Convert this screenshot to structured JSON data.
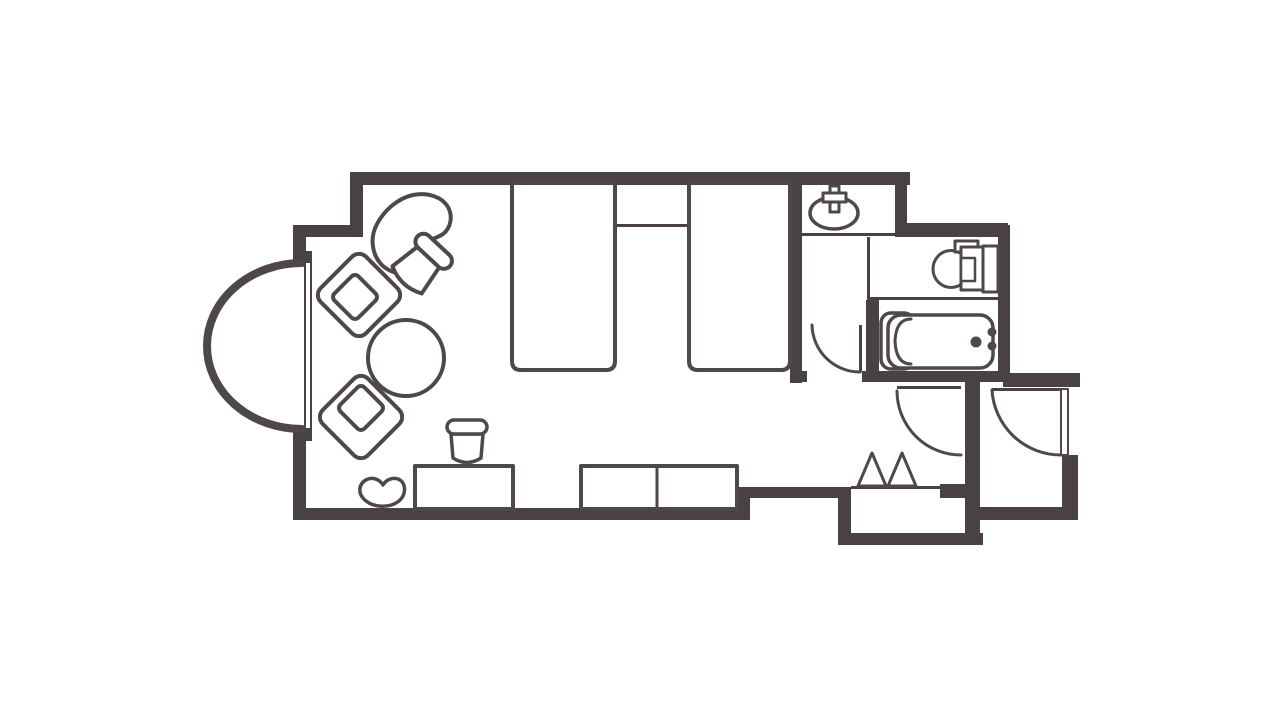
{
  "canvas": {
    "width": 1280,
    "height": 720,
    "background": "#ffffff"
  },
  "palette": {
    "wall": "#494142",
    "line": "#4f4849",
    "fill": "#ffffff"
  },
  "floorplan": {
    "description": "hotel-guest-room-floor-plan",
    "shapes": [
      {
        "name": "top-wall",
        "type": "rect",
        "x": 350,
        "y": 172,
        "w": 560,
        "h": 13,
        "fill": "wall"
      },
      {
        "name": "step-wall-vertical",
        "type": "rect",
        "x": 350,
        "y": 172,
        "w": 13,
        "h": 65,
        "fill": "wall"
      },
      {
        "name": "step-wall-horizontal",
        "type": "rect",
        "x": 293,
        "y": 225,
        "w": 70,
        "h": 12,
        "fill": "wall"
      },
      {
        "name": "left-wall-upper",
        "type": "rect",
        "x": 293,
        "y": 225,
        "w": 13,
        "h": 38,
        "fill": "wall"
      },
      {
        "name": "window-nub-top",
        "type": "rect",
        "x": 293,
        "y": 251,
        "w": 19,
        "h": 12,
        "fill": "wall"
      },
      {
        "name": "left-wall-lower",
        "type": "rect",
        "x": 293,
        "y": 428,
        "w": 13,
        "h": 92,
        "fill": "wall"
      },
      {
        "name": "window-nub-bottom",
        "type": "rect",
        "x": 293,
        "y": 428,
        "w": 19,
        "h": 13,
        "fill": "wall"
      },
      {
        "name": "bottom-wall-main",
        "type": "rect",
        "x": 293,
        "y": 508,
        "w": 457,
        "h": 12,
        "fill": "wall"
      },
      {
        "name": "bottom-wall-step",
        "type": "rect",
        "x": 737,
        "y": 487,
        "w": 13,
        "h": 33,
        "fill": "wall"
      },
      {
        "name": "bottom-wall-right",
        "type": "rect",
        "x": 737,
        "y": 487,
        "w": 110,
        "h": 11,
        "fill": "wall"
      },
      {
        "name": "genkan-wall-left",
        "type": "rect",
        "x": 838,
        "y": 487,
        "w": 13,
        "h": 58,
        "fill": "wall"
      },
      {
        "name": "genkan-wall-bottom",
        "type": "rect",
        "x": 838,
        "y": 533,
        "w": 145,
        "h": 12,
        "fill": "wall"
      },
      {
        "name": "entry-divider-wall",
        "type": "rect",
        "x": 965,
        "y": 378,
        "w": 15,
        "h": 167,
        "fill": "wall"
      },
      {
        "name": "entry-divider-nub",
        "type": "rect",
        "x": 940,
        "y": 484,
        "w": 26,
        "h": 14,
        "fill": "wall"
      },
      {
        "name": "entry-bottom-wall",
        "type": "rect",
        "x": 978,
        "y": 507,
        "w": 100,
        "h": 13,
        "fill": "wall"
      },
      {
        "name": "entry-right-wall",
        "type": "rect",
        "x": 1062,
        "y": 455,
        "w": 16,
        "h": 65,
        "fill": "wall"
      },
      {
        "name": "entry-top-wall",
        "type": "rect",
        "x": 1003,
        "y": 373,
        "w": 77,
        "h": 14,
        "fill": "wall"
      },
      {
        "name": "bathroom-right-wall",
        "type": "rect",
        "x": 998,
        "y": 225,
        "w": 12,
        "h": 157,
        "fill": "wall"
      },
      {
        "name": "bathroom-bottom-wall-left",
        "type": "rect",
        "x": 790,
        "y": 371,
        "w": 17,
        "h": 11,
        "fill": "wall"
      },
      {
        "name": "bathroom-bottom-wall",
        "type": "rect",
        "x": 862,
        "y": 371,
        "w": 148,
        "h": 11,
        "fill": "wall"
      },
      {
        "name": "sink-room-right-wall",
        "type": "rect",
        "x": 895,
        "y": 172,
        "w": 12,
        "h": 65,
        "fill": "wall"
      },
      {
        "name": "toilet-room-top-wall",
        "type": "rect",
        "x": 895,
        "y": 223,
        "w": 113,
        "h": 14,
        "fill": "wall"
      },
      {
        "name": "bedroom-bathroom-wall",
        "type": "rect",
        "x": 790,
        "y": 173,
        "w": 12,
        "h": 210,
        "fill": "wall"
      },
      {
        "name": "tub-room-left-wall",
        "type": "rect",
        "x": 866,
        "y": 300,
        "w": 13,
        "h": 82,
        "fill": "wall"
      },
      {
        "name": "sink-counter-line",
        "type": "rect",
        "x": 797,
        "y": 233,
        "w": 98,
        "h": 3,
        "fill": "wall"
      },
      {
        "name": "washroom-toilet-partition",
        "type": "rect",
        "x": 867,
        "y": 237,
        "w": 3,
        "h": 63,
        "fill": "wall"
      },
      {
        "name": "toilet-tub-partition",
        "type": "rect",
        "x": 867,
        "y": 297,
        "w": 133,
        "h": 3,
        "fill": "wall"
      },
      {
        "name": "bay-window-glass-outer",
        "type": "rect",
        "x": 304,
        "y": 262,
        "w": 2,
        "h": 167,
        "fill": "wall"
      },
      {
        "name": "bay-window-glass-inner",
        "type": "rect",
        "x": 310,
        "y": 262,
        "w": 2,
        "h": 167,
        "fill": "wall"
      },
      {
        "name": "nightstand-front-line",
        "type": "rect",
        "x": 617,
        "y": 224,
        "w": 71,
        "h": 3,
        "fill": "wall"
      },
      {
        "name": "genkan-threshold-line",
        "type": "rect",
        "x": 851,
        "y": 486,
        "w": 90,
        "h": 3,
        "fill": "wall"
      },
      {
        "name": "hall-door-leaf",
        "type": "rect",
        "x": 897,
        "y": 386,
        "w": 64,
        "h": 3,
        "fill": "wall"
      },
      {
        "name": "washroom-door-leaf",
        "type": "rect",
        "x": 859,
        "y": 325,
        "w": 3,
        "h": 47,
        "fill": "wall"
      },
      {
        "name": "entrance-door-header-line",
        "type": "rect",
        "x": 992,
        "y": 388,
        "w": 69,
        "h": 3,
        "fill": "wall"
      },
      {
        "name": "bay-window-arc",
        "type": "path",
        "d": "M 302,263 A 95,83 0 0 0 302,429",
        "sw": 8,
        "fill": "none"
      },
      {
        "name": "washroom-door-arc",
        "type": "path",
        "d": "M 812,325 A 48,48 0 0 0 860,372",
        "sw": 3,
        "fill": "none"
      },
      {
        "name": "hall-door-arc",
        "type": "path",
        "d": "M 897,391 A 64,64 0 0 0 961,455",
        "sw": 3,
        "fill": "none"
      },
      {
        "name": "entrance-door-arc",
        "type": "path",
        "d": "M 992,390 A 69,69 0 0 0 1061,455",
        "sw": 3,
        "fill": "none"
      },
      {
        "name": "entrance-door-leaf",
        "type": "rect",
        "x": 1061,
        "y": 389,
        "w": 7,
        "h": 66,
        "sw": 2,
        "fill": "white"
      },
      {
        "name": "bed-1",
        "type": "path",
        "d": "M 512,183 L 512,361 Q 512,370 521,370 L 606,370 Q 615,370 615,361 L 615,183 Z",
        "sw": 4,
        "fill": "white"
      },
      {
        "name": "bed-2",
        "type": "path",
        "d": "M 689,183 L 689,361 Q 689,370 698,370 L 781,370 Q 790,370 790,361 L 790,183 Z",
        "sw": 4,
        "fill": "white"
      },
      {
        "name": "genkan-step-mark-1",
        "type": "polygon",
        "points": "858,486 872,453 886,486",
        "sw": 3,
        "fill": "white"
      },
      {
        "name": "genkan-step-mark-2",
        "type": "polygon",
        "points": "888,486 902,453 916,486",
        "sw": 3,
        "fill": "white"
      },
      {
        "name": "lounge-chair",
        "type": "path",
        "d": "M 391,271 C 373,263 368,241 377,224 C 385,209 399,198 413,195 C 428,192 442,197 448,207 C 453,216 451,228 443,234 C 436,239 428,239 424,245 C 420,251 422,259 416,266 C 409,274 400,275 391,271 Z",
        "sw": 4,
        "fill": "white"
      },
      {
        "name": "side-chair-body",
        "type": "path",
        "d": "M -15,7 L 15,7 L 20,38 Q 0,48 -20,38 Z",
        "sw": 4,
        "fill": "white",
        "transform": "translate(433,252) rotate(43)"
      },
      {
        "name": "side-chair-back",
        "type": "rect",
        "x": -22,
        "y": -9,
        "w": 44,
        "h": 16,
        "rx": 8,
        "sw": 4,
        "fill": "white",
        "transform": "translate(433,252) rotate(43)"
      },
      {
        "name": "armchair-1-frame",
        "type": "rect",
        "x": -32,
        "y": -32,
        "w": 64,
        "h": 64,
        "rx": 10,
        "sw": 4,
        "fill": "white",
        "transform": "translate(359,295) rotate(45)"
      },
      {
        "name": "armchair-1-seat",
        "type": "rect",
        "x": -17,
        "y": -17,
        "w": 34,
        "h": 34,
        "rx": 5,
        "sw": 4,
        "fill": "white",
        "transform": "translate(355,297) rotate(45)"
      },
      {
        "name": "armchair-2-frame",
        "type": "rect",
        "x": -32,
        "y": -32,
        "w": 64,
        "h": 64,
        "rx": 10,
        "sw": 4,
        "fill": "white",
        "transform": "translate(361,417) rotate(45)"
      },
      {
        "name": "armchair-2-seat",
        "type": "rect",
        "x": -17,
        "y": -17,
        "w": 34,
        "h": 34,
        "rx": 5,
        "sw": 4,
        "fill": "white",
        "transform": "translate(361,408) rotate(45)"
      },
      {
        "name": "round-table",
        "type": "circle",
        "cx": 406,
        "cy": 358,
        "r": 38,
        "sw": 4,
        "fill": "white"
      },
      {
        "name": "desk",
        "type": "rect",
        "x": 415,
        "y": 466,
        "w": 98,
        "h": 43,
        "sw": 4,
        "fill": "white"
      },
      {
        "name": "desk-stool-body",
        "type": "path",
        "d": "M -16,7 L 16,7 L 14,31 Q 0,40 -14,31 Z",
        "sw": 3.5,
        "fill": "white",
        "transform": "translate(467,427)"
      },
      {
        "name": "desk-stool-top",
        "type": "rect",
        "x": -20,
        "y": -7,
        "w": 40,
        "h": 14,
        "rx": 7,
        "sw": 3.5,
        "fill": "white",
        "transform": "translate(467,427)"
      },
      {
        "name": "tv-board",
        "type": "rect",
        "x": 581,
        "y": 466,
        "w": 156,
        "h": 43,
        "sw": 4,
        "fill": "white"
      },
      {
        "name": "tv-board-divider",
        "type": "path",
        "d": "M 657,468 L 657,507",
        "sw": 3,
        "fill": "none"
      },
      {
        "name": "floor-cushion",
        "type": "path",
        "d": "M 366,501 C 357,494 358,483 368,479 C 374,477 380,480 383,485 C 386,480 392,477 398,479 C 406,482 407,494 399,501 C 390,508 375,508 366,501 Z",
        "sw": 3.5,
        "fill": "white"
      },
      {
        "name": "sink-basin",
        "type": "ellipse",
        "cx": 834,
        "cy": 213,
        "rx": 24,
        "ry": 16,
        "sw": 3.5,
        "fill": "white"
      },
      {
        "name": "sink-faucet-vertical",
        "type": "rect",
        "x": 830,
        "y": 186,
        "w": 9,
        "h": 26,
        "sw": 3,
        "fill": "white"
      },
      {
        "name": "sink-faucet-horizontal",
        "type": "rect",
        "x": 823,
        "y": 193,
        "w": 23,
        "h": 9,
        "sw": 3,
        "fill": "white"
      },
      {
        "name": "toilet-bowl",
        "type": "ellipse",
        "cx": 951,
        "cy": 269,
        "rx": 18,
        "ry": 18.5,
        "sw": 3,
        "fill": "white"
      },
      {
        "name": "toilet-lid-box",
        "type": "rect",
        "x": 955,
        "y": 241,
        "w": 23,
        "h": 11,
        "sw": 3,
        "fill": "white"
      },
      {
        "name": "toilet-tank",
        "type": "rect",
        "x": 983,
        "y": 246,
        "w": 15,
        "h": 46,
        "sw": 3,
        "fill": "white"
      },
      {
        "name": "toilet-seat",
        "type": "rect",
        "x": 961,
        "y": 247,
        "w": 22,
        "h": 43,
        "sw": 3,
        "fill": "white"
      },
      {
        "name": "toilet-seat-notch",
        "type": "rect",
        "x": 961,
        "y": 258,
        "w": 14,
        "h": 23,
        "sw": 2.5,
        "fill": "white"
      },
      {
        "name": "bathtub-end-panel",
        "type": "rect",
        "x": 881,
        "y": 313,
        "w": 33,
        "h": 56,
        "rx": 10,
        "sw": 3.5,
        "fill": "white"
      },
      {
        "name": "bathtub",
        "type": "rect",
        "x": 888,
        "y": 315,
        "w": 105,
        "h": 53,
        "rx": 13,
        "sw": 3.5,
        "fill": "white"
      },
      {
        "name": "bathtub-inner-line",
        "type": "path",
        "d": "M 911,319 Q 896,319 895,341 Q 896,364 911,364",
        "sw": 3,
        "fill": "none"
      },
      {
        "name": "bathtub-faucet-dot",
        "type": "circle",
        "cx": 976,
        "cy": 342,
        "r": 5.5,
        "fill": "solid"
      },
      {
        "name": "bathtub-knob-1",
        "type": "circle",
        "cx": 992,
        "cy": 332,
        "r": 4.5,
        "fill": "solid"
      },
      {
        "name": "bathtub-knob-2",
        "type": "circle",
        "cx": 992,
        "cy": 346,
        "r": 4.5,
        "fill": "solid"
      }
    ]
  }
}
